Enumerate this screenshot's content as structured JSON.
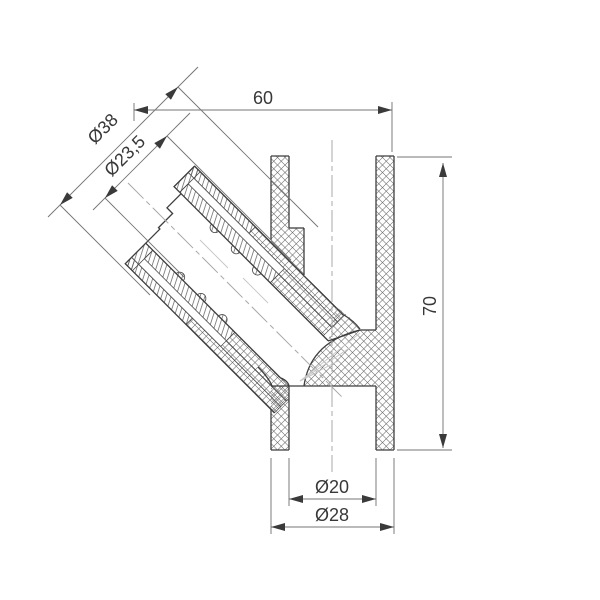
{
  "drawing": {
    "kind": "technical-section-drawing",
    "subject": "45-degree pipe fitting, sectioned view",
    "dimensions": {
      "width_top": {
        "label": "60"
      },
      "height_right": {
        "label": "70"
      },
      "branch_outer_diameter": {
        "label": "Ø38"
      },
      "branch_bore_diameter": {
        "label": "Ø23,5"
      },
      "bottom_bore_diameter": {
        "label": "Ø20"
      },
      "bottom_outer_diameter": {
        "label": "Ø28"
      }
    },
    "colors": {
      "background": "#ffffff",
      "outline": "#3e3e3e",
      "hatch": "#6a6a6a",
      "dimension_line": "#757575",
      "arrow": "#3a3a3a",
      "text": "#383838",
      "centerline": "#a8a8a8",
      "light_line": "#c6c6c6"
    }
  }
}
